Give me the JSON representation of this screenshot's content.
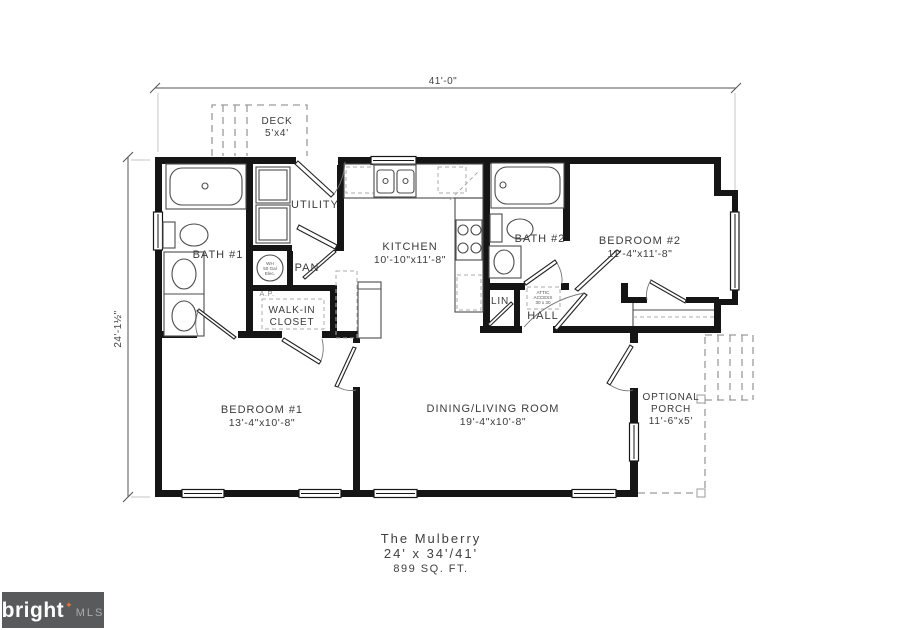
{
  "dimensions": {
    "top": "41'-0\"",
    "left": "24'-1½\""
  },
  "deck": {
    "label": "DECK",
    "size": "5'x4'"
  },
  "rooms": {
    "bath1": {
      "label": "BATH #1"
    },
    "utility": {
      "label": "UTILITY"
    },
    "pantry": {
      "label": "PAN"
    },
    "walk_in_closet": {
      "line1": "WALK-IN",
      "line2": "CLOSET"
    },
    "kitchen": {
      "label": "KITCHEN",
      "size": "10'-10\"x11'-8\""
    },
    "bath2": {
      "label": "BATH #2"
    },
    "linen": {
      "label": "LIN"
    },
    "hall": {
      "label": "HALL"
    },
    "bedroom2": {
      "label": "BEDROOM #2",
      "size": "11'-4\"x11'-8\""
    },
    "bedroom1": {
      "label": "BEDROOM #1",
      "size": "13'-4\"x10'-8\""
    },
    "dining_living": {
      "label": "DINING/LIVING ROOM",
      "size": "19'-4\"x10'-8\""
    },
    "porch": {
      "line1": "OPTIONAL",
      "line2": "PORCH",
      "size": "11'-6\"x5'"
    }
  },
  "annotations": {
    "water_heater": {
      "line1": "WH",
      "line2": "50 Gal",
      "line3": "Elec."
    },
    "access_panel": "A.P.",
    "attic": {
      "line1": "ATTIC",
      "line2": "ACCESS",
      "line3": "30 x 30"
    }
  },
  "title_block": {
    "name": "The Mulberry",
    "size": "24' x 34'/41'",
    "area": "899 SQ. FT."
  },
  "logo": {
    "brand": "bright",
    "star": "✦",
    "suffix": "MLS",
    "background": "#595a5c",
    "accent": "#e0763a"
  }
}
